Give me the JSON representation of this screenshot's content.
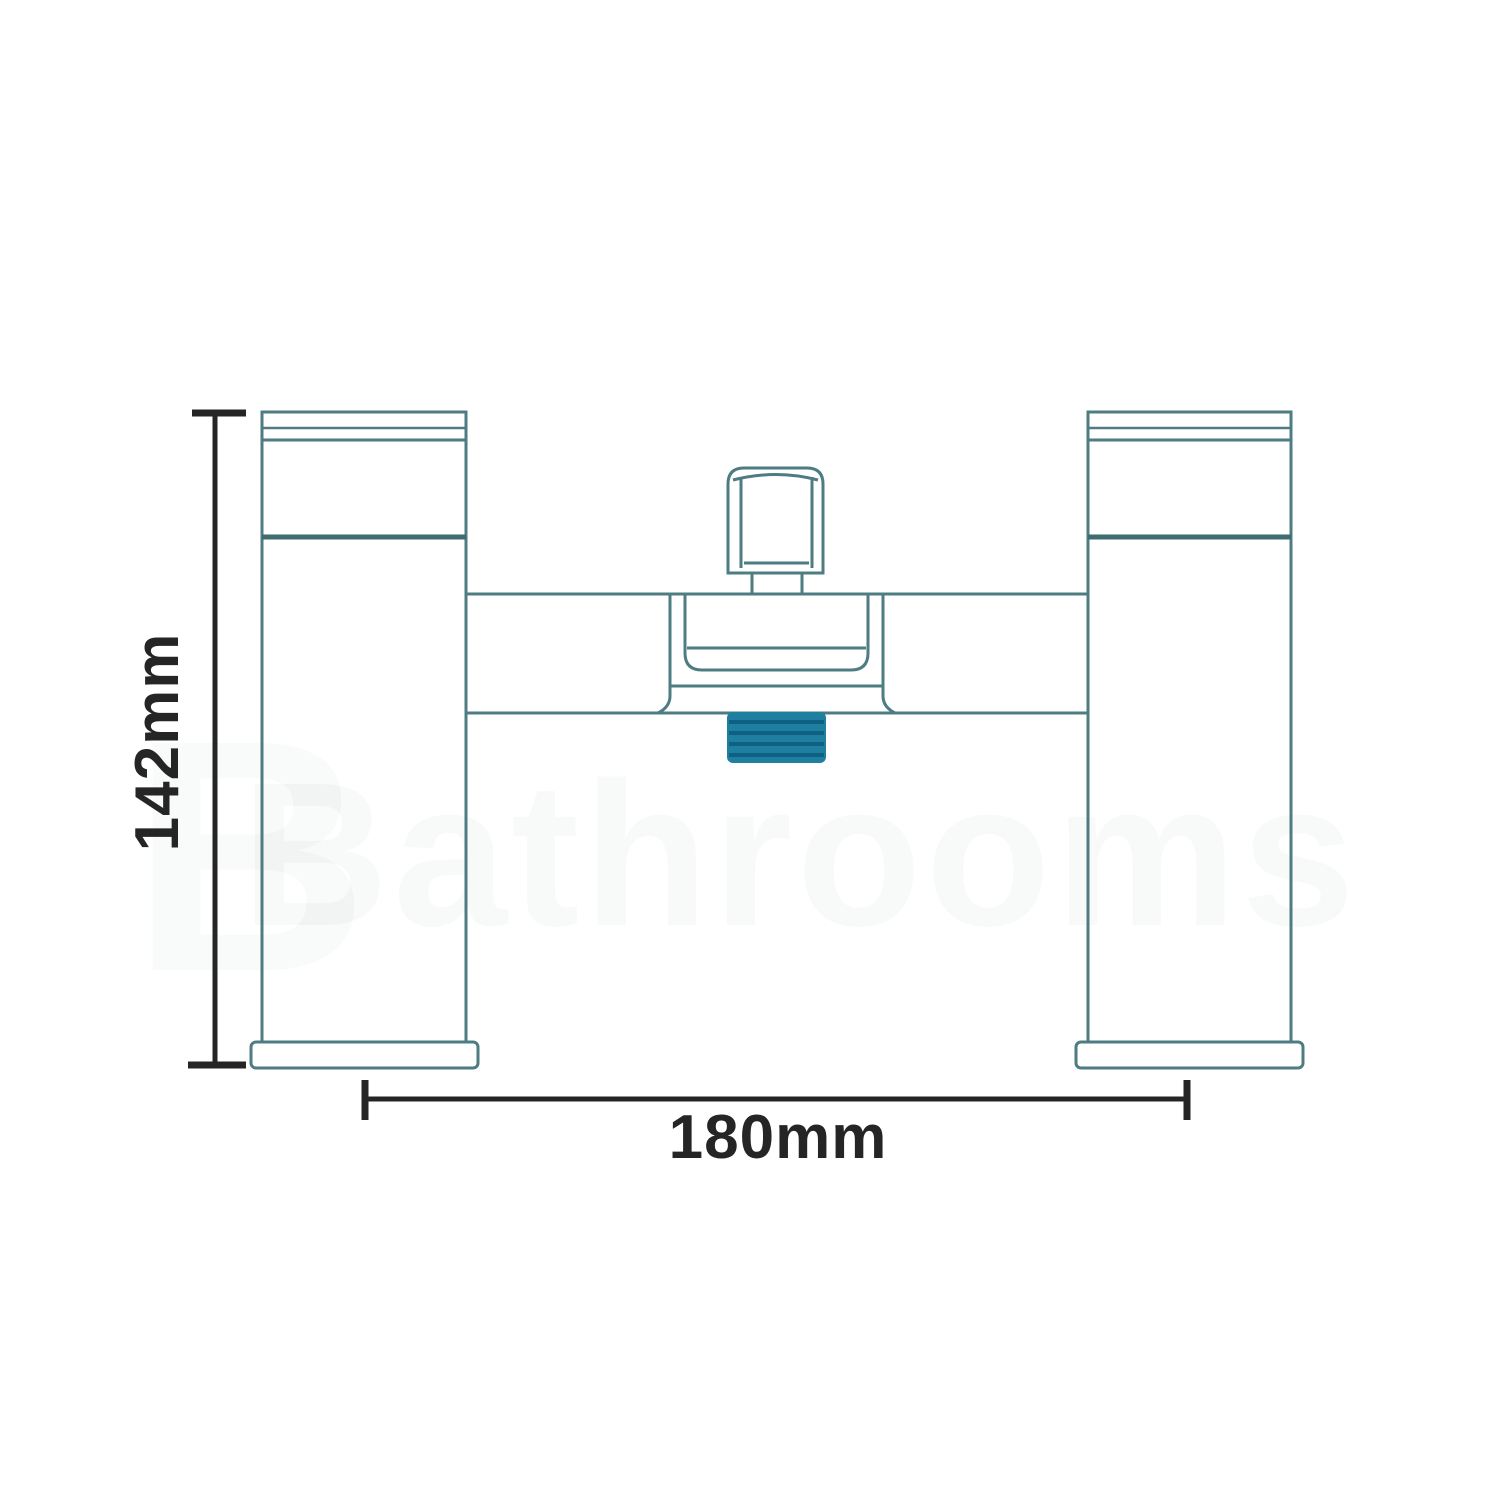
{
  "page": {
    "title": "Bath shower mixer tap technical dimension drawing"
  },
  "drawing": {
    "height_dimension": {
      "label": "142mm"
    },
    "width_dimension": {
      "label": "180mm"
    },
    "watermark": {
      "text": "Bathrooms",
      "initial": "B"
    }
  },
  "colors": {
    "background": "#ffffff",
    "outline": "#4d7c82",
    "outline_dark": "#3e6b70",
    "shape_fill": "#f9fdfd",
    "tint_fill": "#eef7f8",
    "dimension": "#252525",
    "outlet_fill": "#1f7fa0",
    "outlet_stripe": "#0e6183",
    "watermark": "#7f9598"
  }
}
